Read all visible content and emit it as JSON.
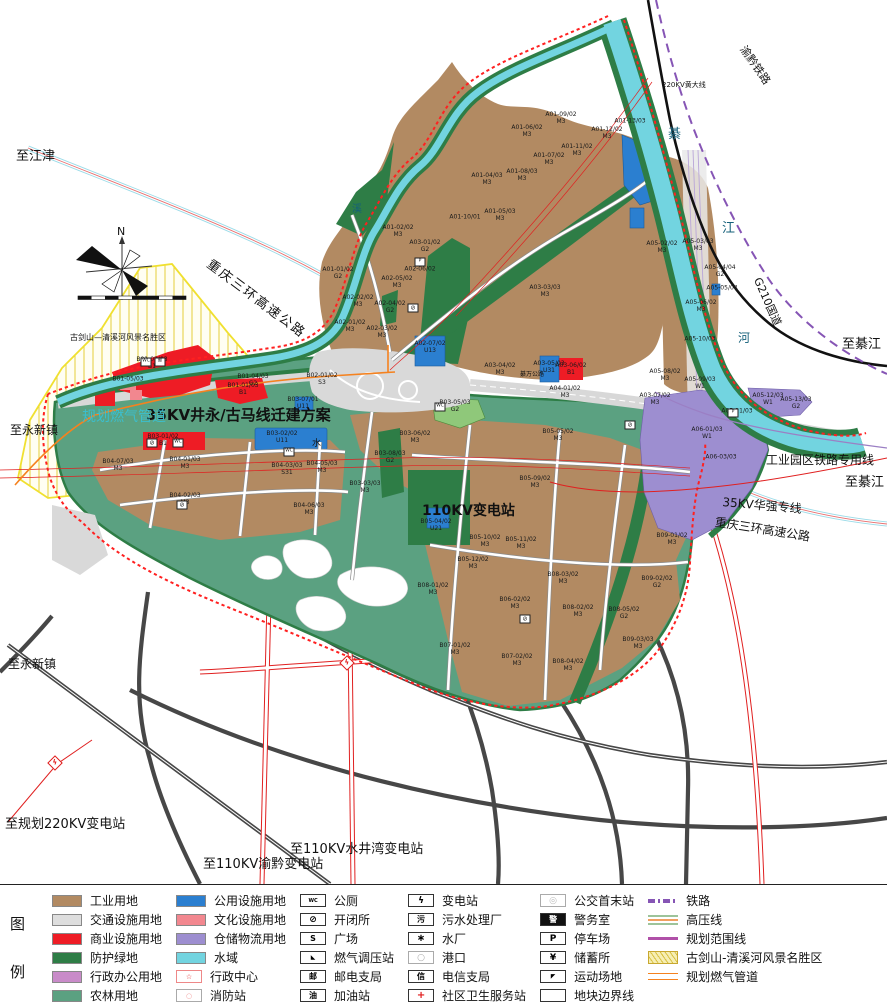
{
  "colors": {
    "industrial": "#b28a62",
    "transport": "#dedede",
    "commercial": "#ee1c25",
    "protective_green": "#2e7d46",
    "admin_office": "#c98bc9",
    "farmland": "#5ba181",
    "public_utility": "#2b7fd0",
    "cultural": "#f2878f",
    "warehouse": "#9d8ed0",
    "water": "#72d4e0",
    "boundary_red": "#ff2020",
    "rail_purple": "#8655b5",
    "gas_orange": "#f5821f",
    "scenic_yellow": "#f0e030"
  },
  "legend": {
    "title_char1": "图",
    "title_char2": "例",
    "columns": [
      {
        "items": [
          {
            "label": "工业用地",
            "kind": "fill",
            "color": "#b28a62"
          },
          {
            "label": "交通设施用地",
            "kind": "fill",
            "color": "#dedede"
          },
          {
            "label": "商业设施用地",
            "kind": "fill",
            "color": "#ee1c25"
          },
          {
            "label": "防护绿地",
            "kind": "fill",
            "color": "#2e7d46"
          },
          {
            "label": "行政办公用地",
            "kind": "fill",
            "color": "#c98bc9"
          },
          {
            "label": "农林用地",
            "kind": "fill",
            "color": "#5ba181"
          }
        ]
      },
      {
        "items": [
          {
            "label": "公用设施用地",
            "kind": "fill",
            "color": "#2b7fd0"
          },
          {
            "label": "文化设施用地",
            "kind": "fill",
            "color": "#f2878f"
          },
          {
            "label": "仓储物流用地",
            "kind": "fill",
            "color": "#9d8ed0"
          },
          {
            "label": "水域",
            "kind": "fill",
            "color": "#72d4e0"
          },
          {
            "label": "行政中心",
            "kind": "symbol",
            "glyph": "☆",
            "glyphColor": "#e01818",
            "border": "#e88"
          },
          {
            "label": "消防站",
            "kind": "symbol",
            "glyph": "○",
            "glyphColor": "#f2a0a0",
            "border": "#aaa"
          }
        ]
      },
      {
        "items": [
          {
            "label": "公厕",
            "kind": "symbol",
            "glyph": "WC",
            "fs": 5
          },
          {
            "label": "开闭所",
            "kind": "symbol",
            "glyph": "⊘",
            "fs": 9
          },
          {
            "label": "广场",
            "kind": "symbol",
            "glyph": "S",
            "fs": 8
          },
          {
            "label": "燃气调压站",
            "kind": "symbol",
            "glyph": "◣",
            "fs": 6
          },
          {
            "label": "邮电支局",
            "kind": "symbol",
            "glyph": "邮",
            "fs": 8
          },
          {
            "label": "加油站",
            "kind": "symbol",
            "glyph": "油",
            "fs": 8
          }
        ]
      },
      {
        "items": [
          {
            "label": "变电站",
            "kind": "symbol",
            "glyph": "ϟ",
            "fs": 9
          },
          {
            "label": "污水处理厂",
            "kind": "symbol",
            "glyph": "污",
            "fs": 8
          },
          {
            "label": "水厂",
            "kind": "symbol",
            "glyph": "∗",
            "fs": 10
          },
          {
            "label": "港口",
            "kind": "symbol",
            "glyph": "○",
            "fs": 9,
            "glyphColor": "#aaa",
            "border": "#aaa"
          },
          {
            "label": "电信支局",
            "kind": "symbol",
            "glyph": "信",
            "fs": 8
          },
          {
            "label": "社区卫生服务站",
            "kind": "symbol",
            "glyph": "+",
            "fs": 10,
            "glyphColor": "#e01818"
          }
        ]
      },
      {
        "items": [
          {
            "label": "公交首末站",
            "kind": "symbol",
            "glyph": "◎",
            "fs": 9,
            "glyphColor": "#bbb",
            "border": "#aaa"
          },
          {
            "label": "警务室",
            "kind": "symbol",
            "glyph": "警",
            "fs": 8,
            "glyphBg": "#111",
            "glyphColor": "#fff"
          },
          {
            "label": "停车场",
            "kind": "symbol",
            "glyph": "P",
            "fs": 9
          },
          {
            "label": "储蓄所",
            "kind": "symbol",
            "glyph": "¥",
            "fs": 9
          },
          {
            "label": "运动场地",
            "kind": "symbol",
            "glyph": "◤",
            "fs": 6
          },
          {
            "label": "地块边界线",
            "kind": "symbol",
            "glyph": "",
            "fs": 6
          }
        ]
      },
      {
        "items": [
          {
            "label": "铁路",
            "kind": "rail"
          },
          {
            "label": "高压线",
            "kind": "hv"
          },
          {
            "label": "规划范围线",
            "kind": "solid"
          },
          {
            "label": "古剑山-清溪河风景名胜区",
            "kind": "hatch"
          },
          {
            "label": "规划燃气管道",
            "kind": "gas"
          }
        ]
      }
    ]
  },
  "map": {
    "labels": [
      {
        "t": "至江津",
        "x": 16,
        "y": 150,
        "s": 13
      },
      {
        "t": "重庆三环高速公路",
        "x": 212,
        "y": 258,
        "s": 13,
        "r": 37,
        "ls": 2
      },
      {
        "t": "220KV黄大线",
        "x": 662,
        "y": 82,
        "s": 7
      },
      {
        "t": "渝黔铁路",
        "x": 747,
        "y": 44,
        "s": 11,
        "r": 55
      },
      {
        "t": "G210国道",
        "x": 762,
        "y": 276,
        "s": 11,
        "r": 66
      },
      {
        "t": "至綦江",
        "x": 842,
        "y": 338,
        "s": 13
      },
      {
        "t": "至綦江",
        "x": 845,
        "y": 476,
        "s": 13
      },
      {
        "t": "工业园区铁路专用线",
        "x": 766,
        "y": 454,
        "s": 12
      },
      {
        "t": "35KV华强专线",
        "x": 723,
        "y": 496,
        "s": 12,
        "r": 5
      },
      {
        "t": "重庆三环高速公路",
        "x": 716,
        "y": 516,
        "s": 12,
        "r": 9
      },
      {
        "t": "35KV井永/古马线迁建方案",
        "x": 146,
        "y": 408,
        "s": 15,
        "b": 1
      },
      {
        "t": "规划燃气管道",
        "x": 82,
        "y": 410,
        "s": 14,
        "c": "#3bbfcf"
      },
      {
        "t": "110KV变电站",
        "x": 422,
        "y": 504,
        "s": 14,
        "b": 1
      },
      {
        "t": "古剑山—清溪河风景名胜区",
        "x": 70,
        "y": 334,
        "s": 8
      },
      {
        "t": "至永新镇",
        "x": 10,
        "y": 424,
        "s": 12
      },
      {
        "t": "至永新镇",
        "x": 8,
        "y": 658,
        "s": 12
      },
      {
        "t": "至规划220KV变电站",
        "x": 5,
        "y": 818,
        "s": 13
      },
      {
        "t": "至110KV渝黔变电站",
        "x": 203,
        "y": 858,
        "s": 13
      },
      {
        "t": "至110KV水井湾变电站",
        "x": 290,
        "y": 843,
        "s": 13
      },
      {
        "t": "綦",
        "x": 668,
        "y": 128,
        "s": 13,
        "c": "#15607a"
      },
      {
        "t": "江",
        "x": 722,
        "y": 222,
        "s": 13,
        "c": "#15607a"
      },
      {
        "t": "河",
        "x": 738,
        "y": 332,
        "s": 12,
        "c": "#15607a"
      },
      {
        "t": "溪",
        "x": 352,
        "y": 205,
        "s": 10,
        "c": "#15607a"
      },
      {
        "t": "綦万公路",
        "x": 520,
        "y": 372,
        "s": 6
      },
      {
        "t": "N",
        "x": 117,
        "y": 226,
        "s": 11
      },
      {
        "t": "水",
        "x": 312,
        "y": 440,
        "s": 9
      }
    ],
    "parcels": [
      {
        "c": "A01-01/02",
        "t": "G2",
        "x": 338,
        "y": 274
      },
      {
        "c": "A01-02/02",
        "t": "M3",
        "x": 398,
        "y": 232
      },
      {
        "c": "A01-04/03",
        "t": "M3",
        "x": 487,
        "y": 180
      },
      {
        "c": "A01-05/03",
        "t": "M3",
        "x": 500,
        "y": 216
      },
      {
        "c": "A01-06/02",
        "t": "M3",
        "x": 527,
        "y": 132
      },
      {
        "c": "A01-07/02",
        "t": "M3",
        "x": 549,
        "y": 160
      },
      {
        "c": "A01-08/03",
        "t": "M3",
        "x": 522,
        "y": 176
      },
      {
        "c": "A01-09/02",
        "t": "M3",
        "x": 561,
        "y": 119
      },
      {
        "c": "A01-10/01",
        "t": "",
        "x": 465,
        "y": 218
      },
      {
        "c": "A01-11/02",
        "t": "M3",
        "x": 577,
        "y": 151
      },
      {
        "c": "A01-12/02",
        "t": "M3",
        "x": 607,
        "y": 134
      },
      {
        "c": "A01-13/03",
        "t": "",
        "x": 630,
        "y": 122
      },
      {
        "c": "A02-01/02",
        "t": "M3",
        "x": 350,
        "y": 327
      },
      {
        "c": "A02-02/02",
        "t": "M3",
        "x": 358,
        "y": 302
      },
      {
        "c": "A02-03/02",
        "t": "M3",
        "x": 382,
        "y": 333
      },
      {
        "c": "A02-04/02",
        "t": "G2",
        "x": 390,
        "y": 308
      },
      {
        "c": "A02-05/02",
        "t": "M3",
        "x": 397,
        "y": 283
      },
      {
        "c": "A02-06/02",
        "t": "",
        "x": 420,
        "y": 270
      },
      {
        "c": "A02-07/02",
        "t": "U13",
        "x": 430,
        "y": 348
      },
      {
        "c": "A03-01/02",
        "t": "G2",
        "x": 425,
        "y": 247
      },
      {
        "c": "A03-03/03",
        "t": "M3",
        "x": 545,
        "y": 292
      },
      {
        "c": "A03-04/02",
        "t": "M3",
        "x": 500,
        "y": 370
      },
      {
        "c": "A03-05/03",
        "t": "U31",
        "x": 549,
        "y": 368
      },
      {
        "c": "A03-06/02",
        "t": "B1",
        "x": 571,
        "y": 370
      },
      {
        "c": "A03-07/02",
        "t": "M3",
        "x": 655,
        "y": 400
      },
      {
        "c": "A04-01/02",
        "t": "M3",
        "x": 565,
        "y": 393
      },
      {
        "c": "A05-02/02",
        "t": "M3",
        "x": 662,
        "y": 248
      },
      {
        "c": "A05-03/03",
        "t": "M3",
        "x": 698,
        "y": 246
      },
      {
        "c": "A05-04/04",
        "t": "G2",
        "x": 720,
        "y": 272
      },
      {
        "c": "A05-05/04",
        "t": "",
        "x": 722,
        "y": 289
      },
      {
        "c": "A05-06/02",
        "t": "M3",
        "x": 701,
        "y": 307
      },
      {
        "c": "A05-08/02",
        "t": "M3",
        "x": 665,
        "y": 376
      },
      {
        "c": "A05-09/03",
        "t": "W1",
        "x": 700,
        "y": 384
      },
      {
        "c": "A05-10/03",
        "t": "",
        "x": 700,
        "y": 340
      },
      {
        "c": "A05-11/03",
        "t": "",
        "x": 737,
        "y": 412
      },
      {
        "c": "A05-12/03",
        "t": "W1",
        "x": 768,
        "y": 400
      },
      {
        "c": "A05-13/03",
        "t": "G2",
        "x": 796,
        "y": 404
      },
      {
        "c": "A06-01/03",
        "t": "W1",
        "x": 707,
        "y": 434
      },
      {
        "c": "A06-03/03",
        "t": "",
        "x": 721,
        "y": 458
      },
      {
        "c": "B01-01/03",
        "t": "B1",
        "x": 243,
        "y": 390
      },
      {
        "c": "B01-02/03",
        "t": "B1",
        "x": 152,
        "y": 364
      },
      {
        "c": "B01-04/03",
        "t": "G2",
        "x": 253,
        "y": 381
      },
      {
        "c": "B01-05/03",
        "t": "",
        "x": 128,
        "y": 380
      },
      {
        "c": "B02-01/02",
        "t": "S3",
        "x": 322,
        "y": 380
      },
      {
        "c": "B03-01/02",
        "t": "B1",
        "x": 163,
        "y": 441
      },
      {
        "c": "B03-02/02",
        "t": "U11",
        "x": 282,
        "y": 438
      },
      {
        "c": "B03-03/03",
        "t": "M3",
        "x": 365,
        "y": 488
      },
      {
        "c": "B03-05/03",
        "t": "G2",
        "x": 455,
        "y": 407
      },
      {
        "c": "B03-06/02",
        "t": "M3",
        "x": 415,
        "y": 438
      },
      {
        "c": "B03-07/01",
        "t": "U11",
        "x": 303,
        "y": 404
      },
      {
        "c": "B03-08/03",
        "t": "G2",
        "x": 390,
        "y": 458
      },
      {
        "c": "B04-01/03",
        "t": "M3",
        "x": 185,
        "y": 464
      },
      {
        "c": "B04-02/03",
        "t": "M3",
        "x": 185,
        "y": 500
      },
      {
        "c": "B04-03/03",
        "t": "S31",
        "x": 287,
        "y": 470
      },
      {
        "c": "B04-05/03",
        "t": "M3",
        "x": 322,
        "y": 468
      },
      {
        "c": "B04-06/03",
        "t": "M3",
        "x": 309,
        "y": 510
      },
      {
        "c": "B04-07/03",
        "t": "M3",
        "x": 118,
        "y": 466
      },
      {
        "c": "B05-04/02",
        "t": "U21",
        "x": 436,
        "y": 526
      },
      {
        "c": "B05-05/02",
        "t": "M3",
        "x": 558,
        "y": 436
      },
      {
        "c": "B05-09/02",
        "t": "M3",
        "x": 535,
        "y": 483
      },
      {
        "c": "B05-10/02",
        "t": "M3",
        "x": 485,
        "y": 542
      },
      {
        "c": "B05-11/02",
        "t": "M3",
        "x": 521,
        "y": 544
      },
      {
        "c": "B05-12/02",
        "t": "M3",
        "x": 473,
        "y": 564
      },
      {
        "c": "B06-02/02",
        "t": "M3",
        "x": 515,
        "y": 604
      },
      {
        "c": "B07-01/02",
        "t": "M3",
        "x": 455,
        "y": 650
      },
      {
        "c": "B07-02/02",
        "t": "M3",
        "x": 517,
        "y": 661
      },
      {
        "c": "B08-01/02",
        "t": "M3",
        "x": 433,
        "y": 590
      },
      {
        "c": "B08-02/02",
        "t": "M3",
        "x": 578,
        "y": 612
      },
      {
        "c": "B08-03/02",
        "t": "M3",
        "x": 563,
        "y": 579
      },
      {
        "c": "B08-04/02",
        "t": "M3",
        "x": 568,
        "y": 666
      },
      {
        "c": "B08-05/02",
        "t": "G2",
        "x": 624,
        "y": 614
      },
      {
        "c": "B09-01/02",
        "t": "M3",
        "x": 672,
        "y": 540
      },
      {
        "c": "B09-02/02",
        "t": "G2",
        "x": 657,
        "y": 583
      },
      {
        "c": "B09-03/03",
        "t": "M3",
        "x": 638,
        "y": 644
      }
    ],
    "markers": [
      {
        "k": "toilet",
        "x": 146,
        "y": 362
      },
      {
        "k": "post",
        "x": 160,
        "y": 362
      },
      {
        "k": "switch",
        "x": 152,
        "y": 443
      },
      {
        "k": "toilet",
        "x": 178,
        "y": 443
      },
      {
        "k": "toilet",
        "x": 289,
        "y": 452
      },
      {
        "k": "toilet",
        "x": 440,
        "y": 407
      },
      {
        "k": "switch",
        "x": 182,
        "y": 505
      },
      {
        "k": "switch",
        "x": 413,
        "y": 308
      },
      {
        "k": "switch",
        "x": 525,
        "y": 619
      },
      {
        "k": "switch",
        "x": 630,
        "y": 425
      },
      {
        "k": "parking",
        "x": 420,
        "y": 262
      },
      {
        "k": "parking",
        "x": 733,
        "y": 413
      },
      {
        "k": "sub",
        "x": 55,
        "y": 763
      },
      {
        "k": "sub",
        "x": 347,
        "y": 663
      }
    ]
  }
}
